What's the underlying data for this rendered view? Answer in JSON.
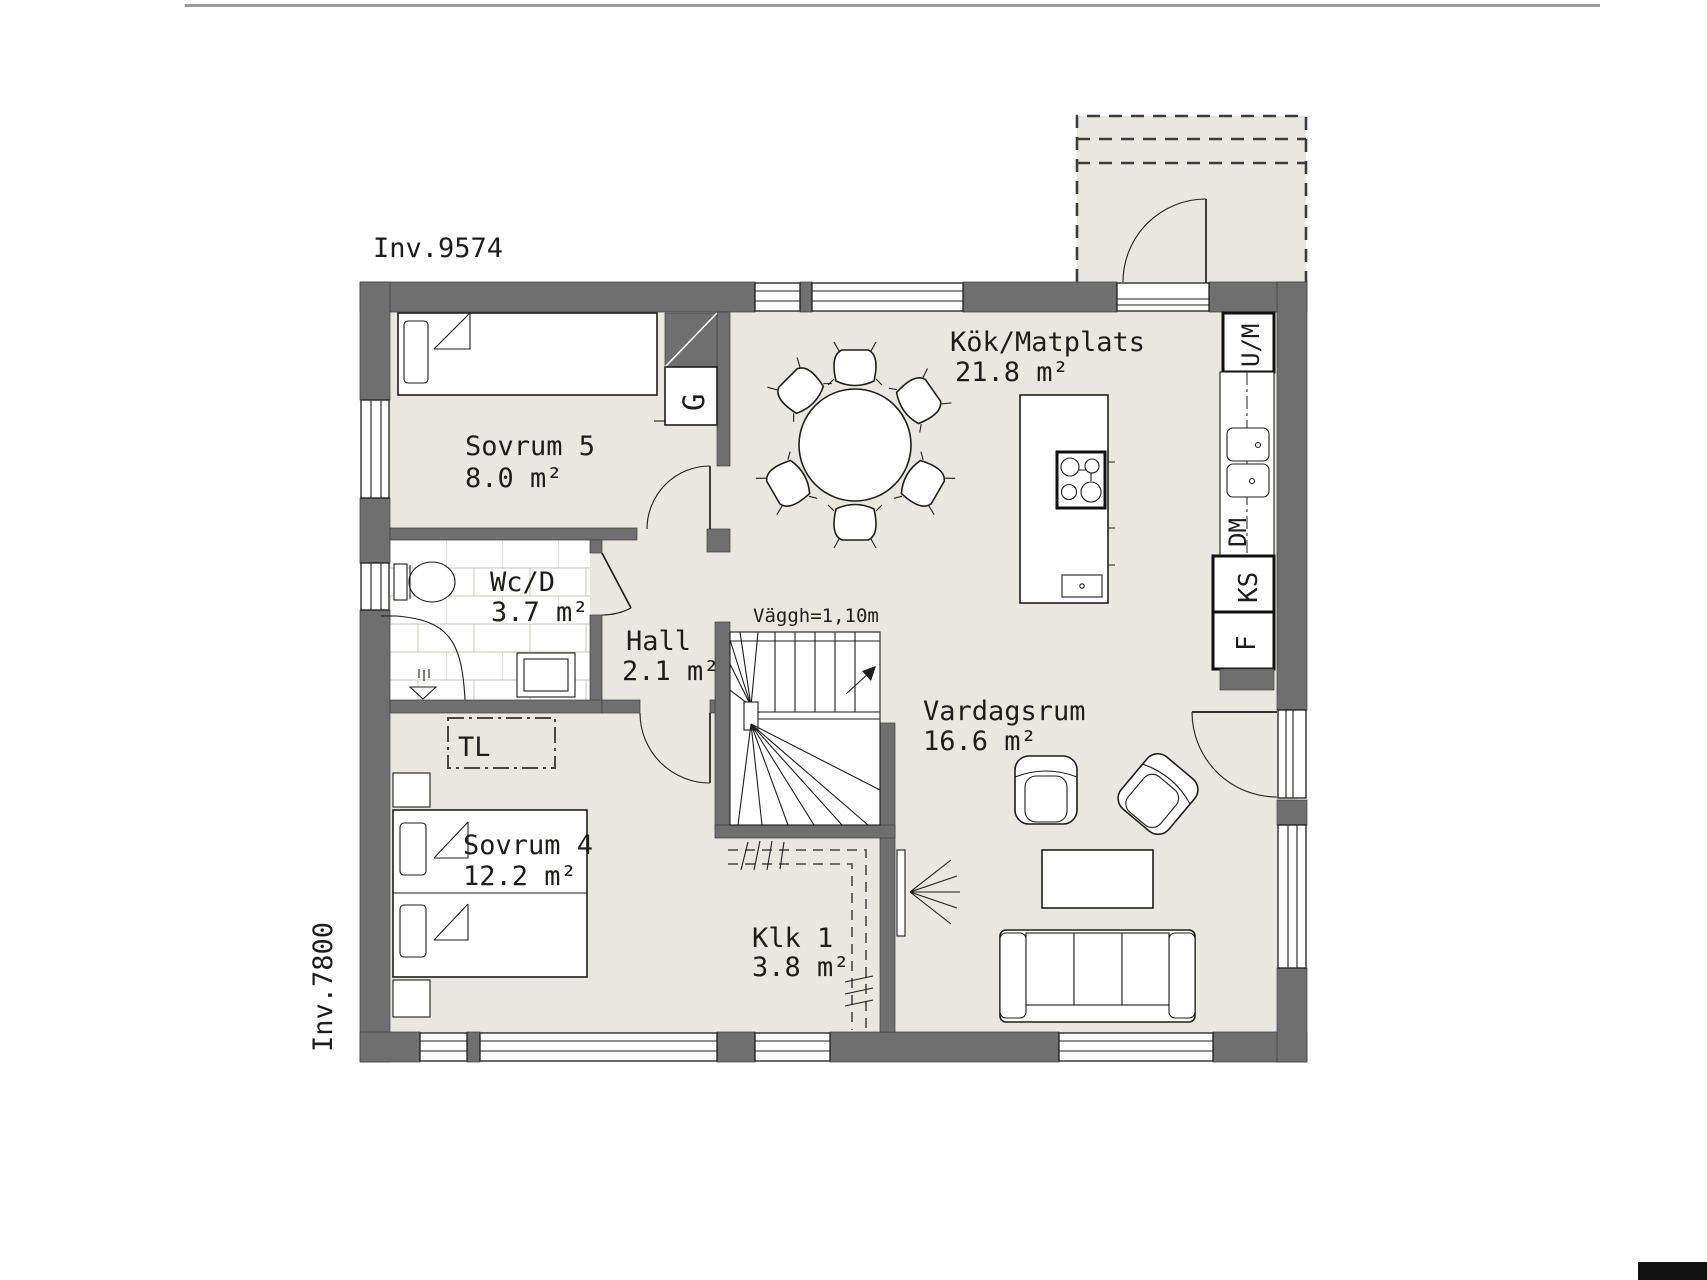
{
  "plan": {
    "dimension_labels": {
      "width": "Inv.9574",
      "height": "Inv.7800"
    },
    "stair_note": "Väggh=1,10m",
    "rooms": [
      {
        "id": "sovrum5",
        "name": "Sovrum 5",
        "area": "8.0 m²"
      },
      {
        "id": "wc",
        "name": "Wc/D",
        "area": "3.7 m²"
      },
      {
        "id": "hall",
        "name": "Hall",
        "area": "2.1 m²"
      },
      {
        "id": "kok",
        "name": "Kök/Matplats",
        "area": "21.8 m²"
      },
      {
        "id": "vardagsrum",
        "name": "Vardagsrum",
        "area": "16.6 m²"
      },
      {
        "id": "sovrum4",
        "name": "Sovrum 4",
        "area": "12.2 m²"
      },
      {
        "id": "klk",
        "name": "Klk 1",
        "area": "3.8 m²"
      }
    ],
    "closets": {
      "wardrobe": "G",
      "laundry_reserve": "TL"
    },
    "appliances": {
      "oven_micro": "U/M",
      "dishwasher": "DM",
      "fridge": "KS",
      "freezer": "F"
    },
    "colors": {
      "wall": "#6f6f6f",
      "floor": "#e9e8e0",
      "line": "#1d1d1b",
      "tile_grout": "#c6c5bd",
      "top_rule": "#9b9b9b",
      "corner_block": "#111111"
    }
  }
}
